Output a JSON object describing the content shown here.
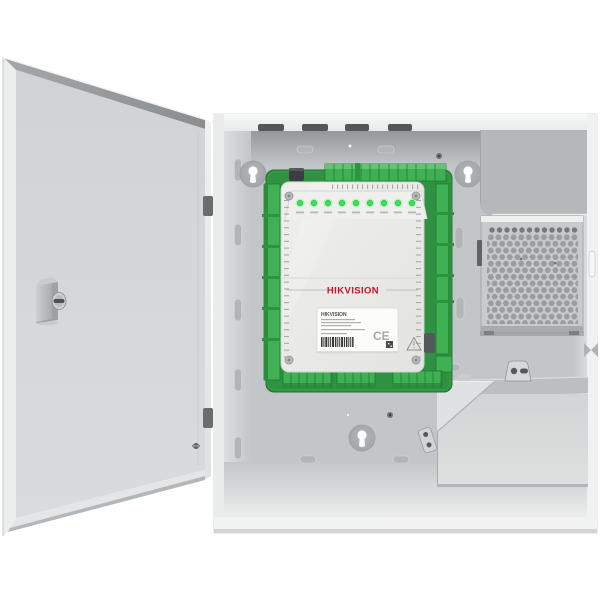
{
  "branding": {
    "logo": "HIKVISION",
    "label_title": "HIKVISION",
    "ce_mark": "CE"
  },
  "board": {
    "led_count": 9
  },
  "colors": {
    "background": "#ffffff",
    "enclosure_gray": "#c3c6c8",
    "door_gray": "#d4d6d8",
    "pcb_green": "#2f9242",
    "terminal_green": "#3fb053",
    "led_green": "#3ae156",
    "logo_red": "#ce1126",
    "cover_offwhite": "#ebebe9",
    "psu_gray": "#c8cbcc"
  }
}
